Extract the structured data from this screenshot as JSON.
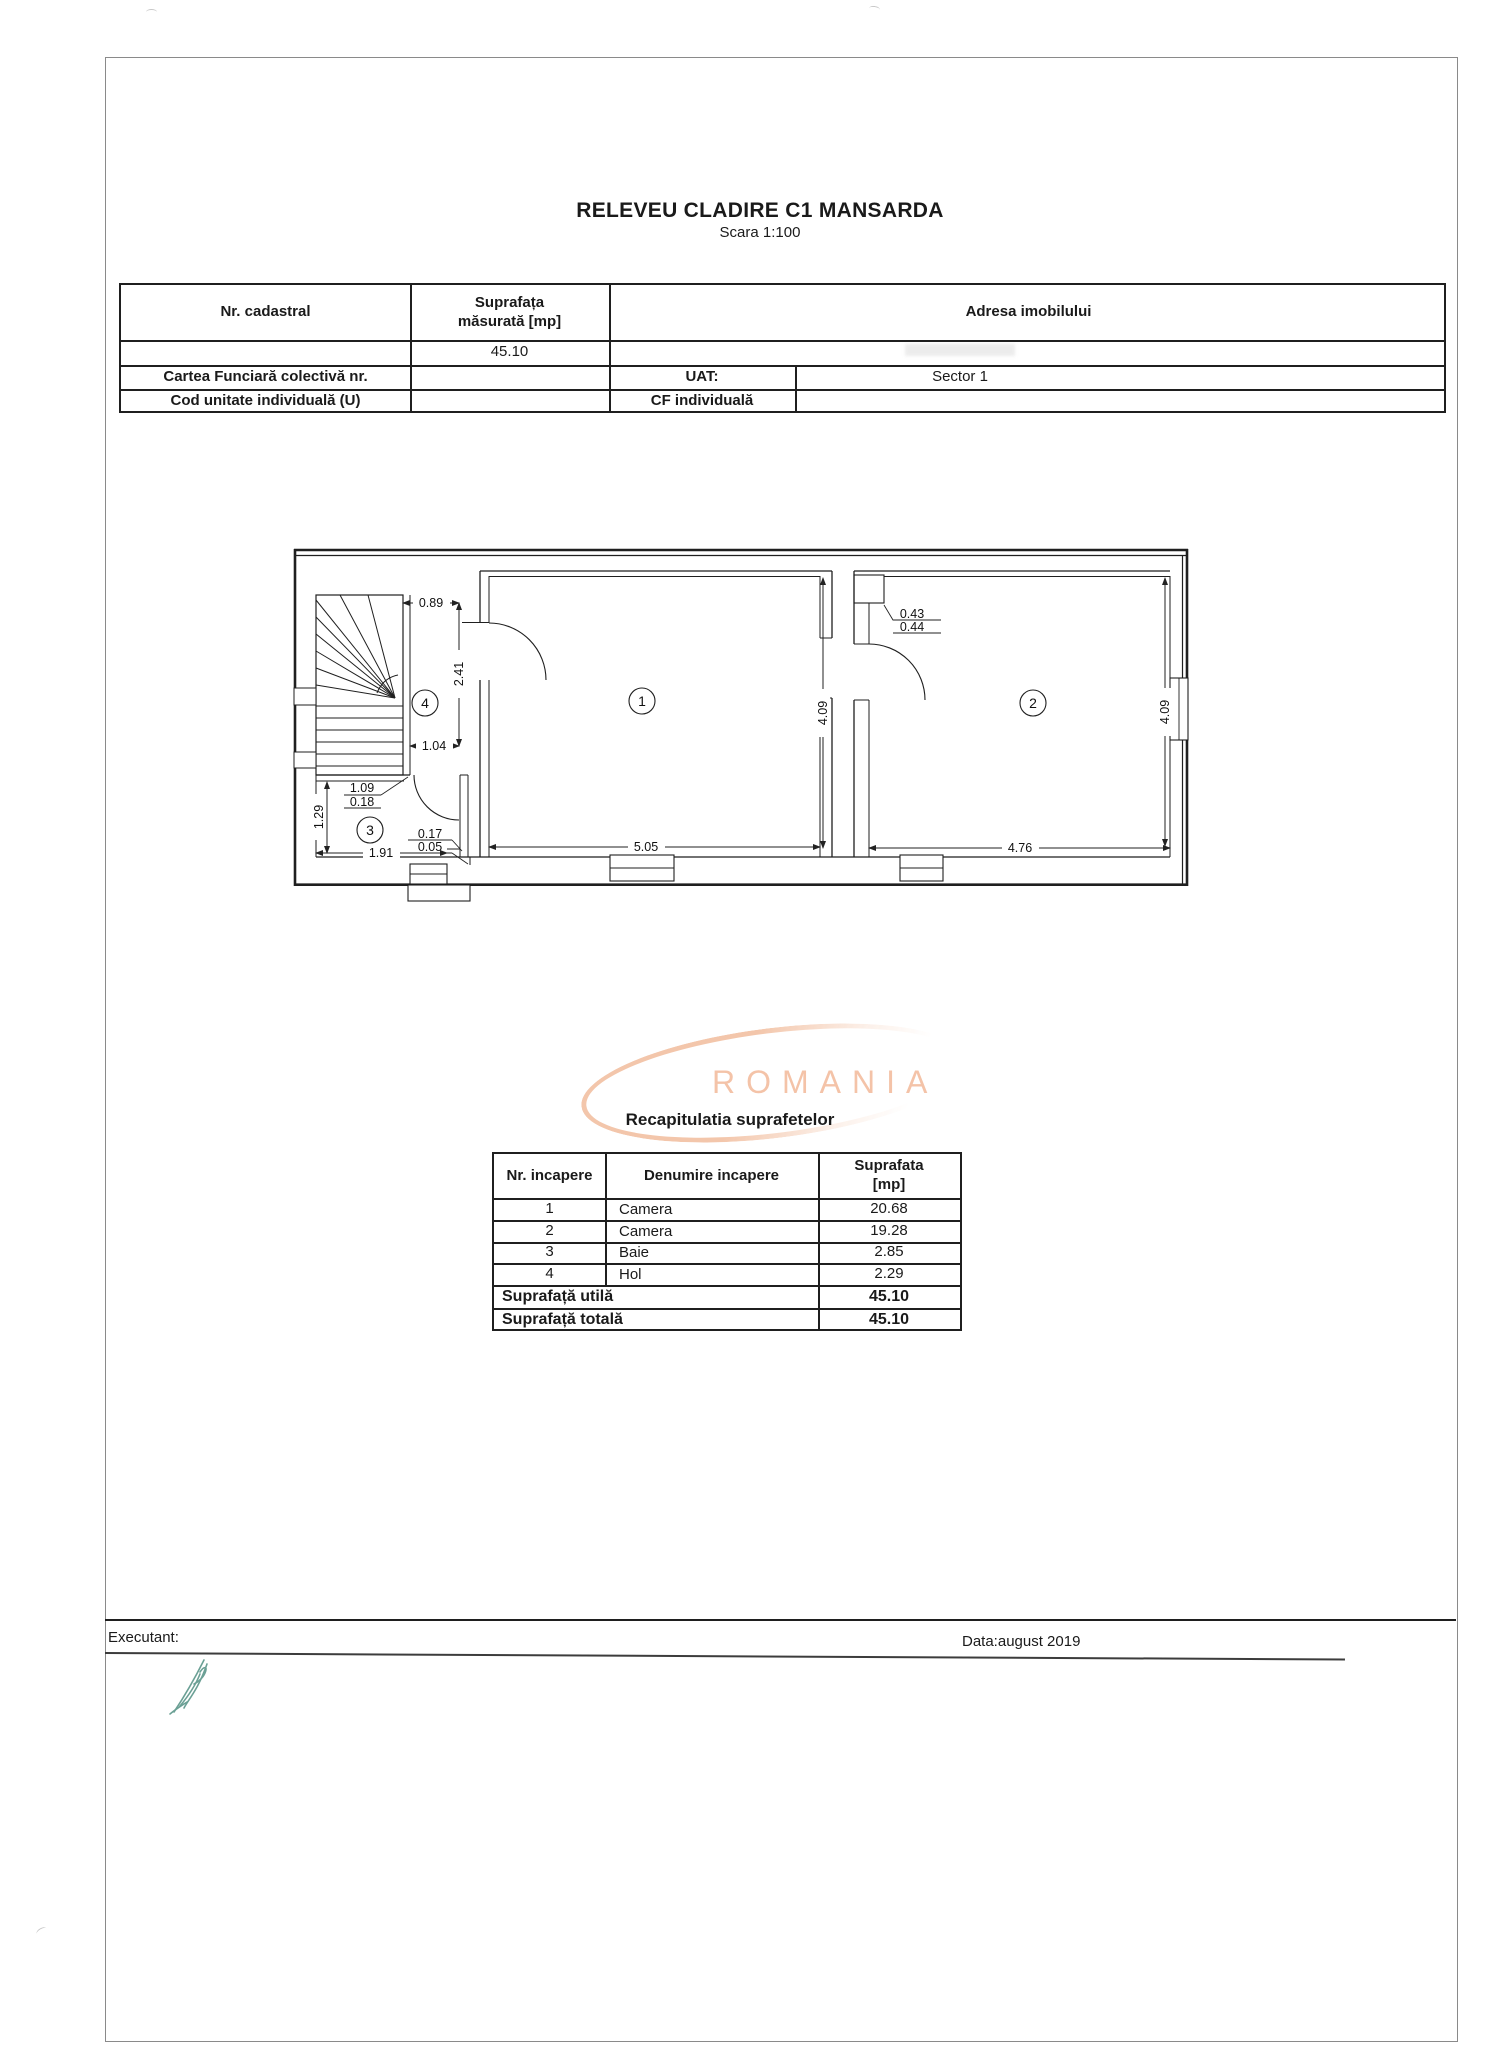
{
  "document": {
    "title": "RELEVEU CLADIRE C1 MANSARDA",
    "scale": "Scara 1:100"
  },
  "info_table": {
    "col_nr_cadastral": "Nr. cadastral",
    "col_suprafata_line1": "Suprafața",
    "col_suprafata_line2": "măsurată [mp]",
    "col_adresa": "Adresa imobilului",
    "suprafata_value": "45.10",
    "row_cartea": "Cartea Funciară colectivă nr.",
    "uat_label": "UAT:",
    "uat_value": "Sector 1",
    "row_cod": "Cod unitate individuală (U)",
    "cf_label": "CF individuală"
  },
  "plan": {
    "room1": "1",
    "room2": "2",
    "room3": "3",
    "room4": "4",
    "dims": {
      "d089": "0.89",
      "d241": "2.41",
      "d104": "1.04",
      "d109": "1.09",
      "d018": "0.18",
      "d129": "1.29",
      "d017": "0.17",
      "d005": "0.05",
      "d191": "1.91",
      "d505": "5.05",
      "d476": "4.76",
      "d409a": "4.09",
      "d409b": "4.09",
      "d043": "0.43",
      "d044": "0.44"
    }
  },
  "watermark": {
    "text": "ROMANIA",
    "color": "#f2c0a2"
  },
  "recap": {
    "title": "Recapitulatia suprafetelor",
    "h_nr": "Nr. incapere",
    "h_den": "Denumire incapere",
    "h_sup1": "Suprafata",
    "h_sup2": "[mp]",
    "rows": [
      {
        "nr": "1",
        "name": "Camera",
        "area": "20.68"
      },
      {
        "nr": "2",
        "name": "Camera",
        "area": "19.28"
      },
      {
        "nr": "3",
        "name": "Baie",
        "area": "2.85"
      },
      {
        "nr": "4",
        "name": "Hol",
        "area": "2.29"
      }
    ],
    "utila_label": "Suprafață utilă",
    "utila_value": "45.10",
    "totala_label": "Suprafață totală",
    "totala_value": "45.10"
  },
  "footer": {
    "executant": "Executant:",
    "date": "Data:august 2019"
  }
}
